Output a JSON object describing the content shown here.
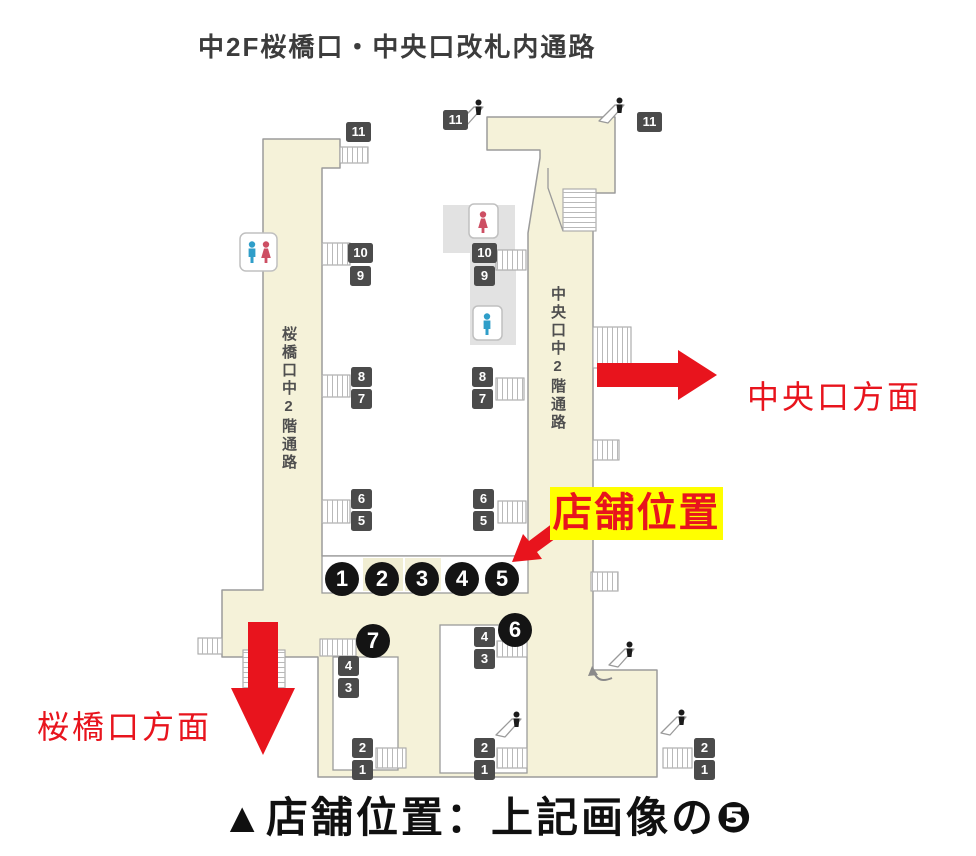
{
  "title": "中2F桜橋口・中央口改札内通路",
  "caption": "▲店舗位置：上記画像の❺",
  "map": {
    "left_corridor_label": "桜橋口中2階通路",
    "right_corridor_label": "中央口中2階通路",
    "store_location_callout": "店舗位置",
    "direction_central_exit": "中央口方面",
    "direction_sakurabashi_exit": "桜橋口方面",
    "shop_numbers": [
      "1",
      "2",
      "3",
      "4",
      "5",
      "6",
      "7"
    ],
    "platform_badges": [
      "11",
      "11",
      "11",
      "10",
      "9",
      "10",
      "9",
      "8",
      "7",
      "8",
      "7",
      "6",
      "5",
      "6",
      "5",
      "4",
      "3",
      "4",
      "3",
      "2",
      "1",
      "2",
      "1",
      "2",
      "1"
    ],
    "colors": {
      "corridor_fill": "#f5f2d9",
      "outline_gray": "#9b9b9b",
      "badge_bg": "#4b4b4b",
      "accent_red": "#e8141d",
      "highlight_yellow": "#ffff00",
      "shop_circle_black": "#141414",
      "toilet_male_blue": "#2f9ec9",
      "toilet_female_red": "#cd4f63"
    }
  }
}
